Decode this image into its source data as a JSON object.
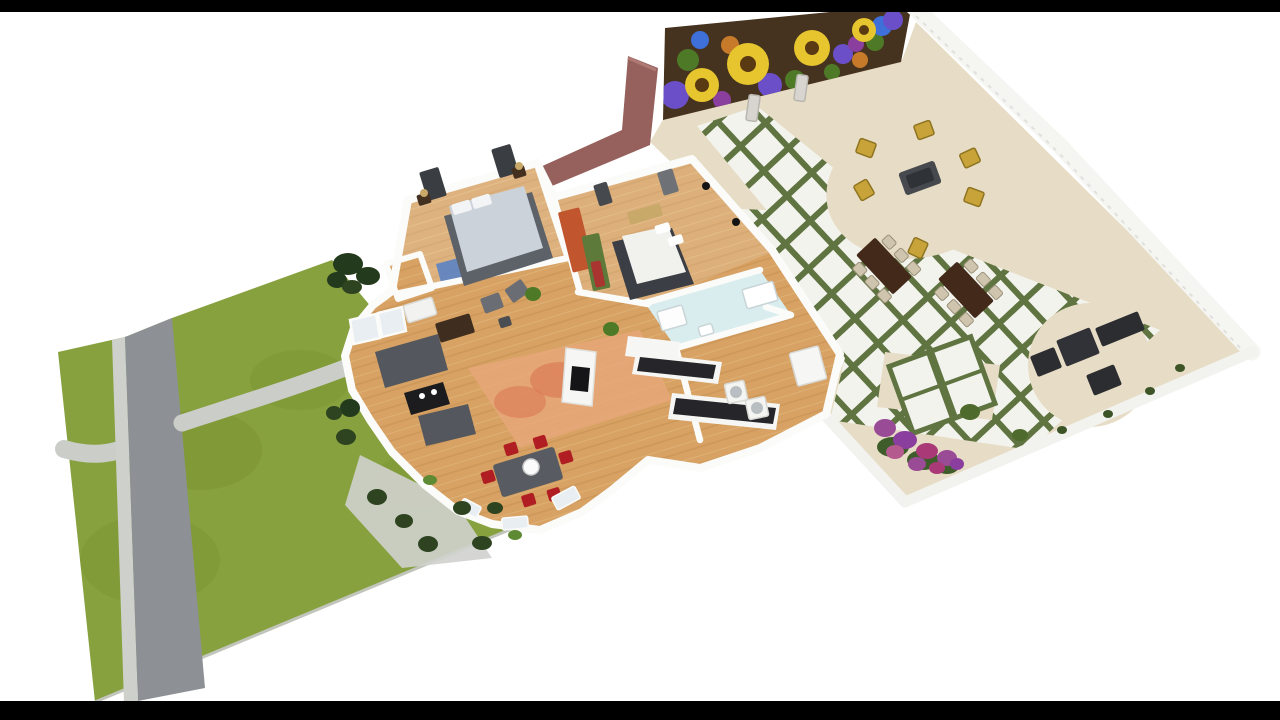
{
  "palette": {
    "background": "#ffffff",
    "letterbox": "#000000",
    "lawn": "#87a13f",
    "lawnPatch": "#79932f",
    "lawnRim": "#c2c5bb",
    "road": "#8d9195",
    "roadEdge": "#cdd0cb",
    "path": "#cbcdc9",
    "apron": "#d0d2ce",
    "patioFloor": "#e7dcc5",
    "tileWhite": "#f3f3ee",
    "tileGrout": "#5f7440",
    "fence": "#f5f5f2",
    "fenceLine": "#e0e0dc",
    "patioWall": "#f2f2ef",
    "muralBase": "#46331f",
    "muralYellow": "#e6c52f",
    "muralCenter": "#5a3a12",
    "muralPurple": "#6a4fc8",
    "muralMagenta": "#8a3f9e",
    "muralLeaf": "#4e7a28",
    "muralBlue": "#3f6fd8",
    "muralOrange": "#c77b2a",
    "maroonWall": "#96605c",
    "wall": "#fbfbf9",
    "wood": "#d7a263",
    "woodLine": "#c08a4c",
    "bathFloor": "#d9edef",
    "rugOrange": "#e8a77b",
    "rugSpot": "#d96f4e",
    "rugBlue": "#5b82c4",
    "bedPlatform": "#5d6168",
    "bedGray": "#ccd2d9",
    "bedWhite": "#f1f1ee",
    "bedDark": "#3b3f45",
    "sofaGray": "#54575d",
    "coffeeTable": "#1c1c1f",
    "diningTable": "#585c62",
    "redChair": "#b01e23",
    "counterBlack": "#26262a",
    "cabinetWhite": "#f6f6f4",
    "patioTableBrown": "#43291a",
    "patioChairPale": "#cfc5ae",
    "loungeDark": "#2c2d31",
    "seatYellow": "#c7a339",
    "seatTableGray": "#46494e",
    "shrubDark": "#2e4420",
    "bushDark": "#243a1c",
    "shrubBright": "#5d8a33",
    "patioShrub": "#4e6b2d",
    "flowerGreen": "#3f5d2a",
    "flowerPurple": "#9a4b96",
    "flowerViolet": "#8a3f9e",
    "flowerMagenta": "#a93a77",
    "flowerPink": "#b55a8f",
    "glass": "#e8eef2",
    "vase": "#d8d5d0"
  },
  "scene": {
    "stamps": [
      {
        "name": "master-window-icon",
        "type": "rect",
        "x": 433,
        "y": 184,
        "w": 20,
        "h": 30,
        "rot": -17,
        "fill": "#3a3d42"
      },
      {
        "name": "master-window-icon",
        "type": "rect",
        "x": 505,
        "y": 161,
        "w": 20,
        "h": 30,
        "rot": -17,
        "fill": "#3a3d42"
      },
      {
        "name": "bedroom2-window-icon",
        "type": "rect",
        "x": 603,
        "y": 194,
        "w": 14,
        "h": 22,
        "rot": -17,
        "fill": "#46494e"
      },
      {
        "name": "bedroom2-window-icon",
        "type": "rect",
        "x": 668,
        "y": 182,
        "w": 16,
        "h": 24,
        "rot": -17,
        "fill": "#6e7276"
      },
      {
        "name": "nightstand",
        "type": "rect",
        "x": 424,
        "y": 199,
        "w": 13,
        "h": 11,
        "rot": -17,
        "fill": "#43301f"
      },
      {
        "name": "nightstand",
        "type": "rect",
        "x": 519,
        "y": 172,
        "w": 13,
        "h": 11,
        "rot": -17,
        "fill": "#43301f"
      },
      {
        "name": "lamp",
        "type": "ellipse",
        "x": 424,
        "y": 193,
        "rx": 4,
        "ry": 4,
        "fill": "#c9a969"
      },
      {
        "name": "lamp",
        "type": "ellipse",
        "x": 519,
        "y": 166,
        "rx": 4,
        "ry": 4,
        "fill": "#c9a969"
      },
      {
        "name": "hall-art-panel",
        "type": "rect",
        "x": 576,
        "y": 240,
        "w": 22,
        "h": 62,
        "rot": -14,
        "fill": "#c0552e"
      },
      {
        "name": "hall-art-panel",
        "type": "rect",
        "x": 596,
        "y": 262,
        "w": 18,
        "h": 56,
        "rot": -12,
        "fill": "#5d7a3b"
      },
      {
        "name": "hall-art-panel",
        "type": "rect",
        "x": 598,
        "y": 274,
        "w": 10,
        "h": 26,
        "rot": -12,
        "fill": "#a8352f"
      },
      {
        "name": "bedroom2-bench",
        "type": "rect",
        "x": 645,
        "y": 214,
        "w": 34,
        "h": 13,
        "rot": -16,
        "fill": "#c9a969"
      },
      {
        "name": "wall-speaker-icon",
        "type": "ellipse",
        "x": 706,
        "y": 186,
        "rx": 4,
        "ry": 4,
        "fill": "#141414"
      },
      {
        "name": "wall-speaker-icon",
        "type": "ellipse",
        "x": 736,
        "y": 222,
        "rx": 4,
        "ry": 4,
        "fill": "#141414"
      },
      {
        "name": "dresser",
        "type": "rect",
        "x": 420,
        "y": 310,
        "w": 30,
        "h": 18,
        "rot": -17,
        "fill": "#f2f2f0",
        "stroke": "#d8d8d4"
      },
      {
        "name": "tv-cabinet",
        "type": "rect",
        "x": 455,
        "y": 328,
        "w": 36,
        "h": 20,
        "rot": -17,
        "fill": "#3f2d1f"
      },
      {
        "name": "armchair",
        "type": "rect",
        "x": 492,
        "y": 303,
        "w": 20,
        "h": 16,
        "rot": -20,
        "fill": "#6a6e74"
      },
      {
        "name": "armchair",
        "type": "rect",
        "x": 517,
        "y": 291,
        "w": 20,
        "h": 16,
        "rot": -35,
        "fill": "#6a6e74"
      },
      {
        "name": "side-table",
        "type": "rect",
        "x": 505,
        "y": 322,
        "w": 12,
        "h": 10,
        "rot": -17,
        "fill": "#4a4d52"
      },
      {
        "name": "plant",
        "type": "ellipse",
        "x": 533,
        "y": 294,
        "rx": 8,
        "ry": 7,
        "fill": "#4e7a28"
      },
      {
        "name": "plant",
        "type": "ellipse",
        "x": 611,
        "y": 329,
        "rx": 8,
        "ry": 7,
        "fill": "#4e7a28"
      },
      {
        "name": "bathtub",
        "type": "rect",
        "x": 760,
        "y": 295,
        "w": 32,
        "h": 20,
        "rot": -16,
        "fill": "#ffffff",
        "stroke": "#c9d4d6"
      },
      {
        "name": "shower",
        "type": "rect",
        "x": 672,
        "y": 318,
        "w": 26,
        "h": 20,
        "rot": -16,
        "fill": "#fdfdfd",
        "stroke": "#c9d4d6"
      },
      {
        "name": "bathroom-sink",
        "type": "rect",
        "x": 706,
        "y": 330,
        "w": 14,
        "h": 10,
        "rot": -16,
        "fill": "#ffffff",
        "stroke": "#c9d4d6"
      },
      {
        "name": "washer",
        "type": "rect",
        "x": 736,
        "y": 392,
        "w": 20,
        "h": 20,
        "rot": -12,
        "fill": "#f4f4f2",
        "stroke": "#d8d8d4"
      },
      {
        "name": "dryer",
        "type": "rect",
        "x": 757,
        "y": 408,
        "w": 20,
        "h": 20,
        "rot": -12,
        "fill": "#f4f4f2",
        "stroke": "#d8d8d4"
      },
      {
        "name": "washer-door-icon",
        "type": "ellipse",
        "x": 736,
        "y": 392,
        "rx": 6,
        "ry": 6,
        "fill": "#b9bec2"
      },
      {
        "name": "dryer-door-icon",
        "type": "ellipse",
        "x": 757,
        "y": 408,
        "rx": 6,
        "ry": 6,
        "fill": "#b9bec2"
      },
      {
        "name": "fridge",
        "type": "rect",
        "x": 808,
        "y": 366,
        "w": 30,
        "h": 34,
        "rot": -15,
        "fill": "#f6f6f4",
        "stroke": "#d8d8d4"
      },
      {
        "name": "bay-window",
        "type": "rect",
        "x": 566,
        "y": 498,
        "w": 26,
        "h": 14,
        "rot": -28,
        "fill": "#e8eef2",
        "stroke": "#fbfbf9"
      },
      {
        "name": "bay-window",
        "type": "rect",
        "x": 515,
        "y": 523,
        "w": 26,
        "h": 12,
        "rot": -5,
        "fill": "#e8eef2",
        "stroke": "#fbfbf9"
      },
      {
        "name": "bay-window",
        "type": "rect",
        "x": 470,
        "y": 508,
        "w": 20,
        "h": 12,
        "rot": 28,
        "fill": "#e8eef2",
        "stroke": "#fbfbf9"
      },
      {
        "name": "pendant-light",
        "type": "ellipse",
        "x": 531,
        "y": 467,
        "rx": 8,
        "ry": 8,
        "fill": "#fbfbfb",
        "stroke": "#cccccc"
      },
      {
        "name": "garden-bush",
        "type": "ellipse",
        "x": 348,
        "y": 264,
        "rx": 15,
        "ry": 11,
        "fill": "#243a1c"
      },
      {
        "name": "garden-bush",
        "type": "ellipse",
        "x": 368,
        "y": 276,
        "rx": 12,
        "ry": 9,
        "fill": "#243a1c"
      },
      {
        "name": "garden-bush",
        "type": "ellipse",
        "x": 337,
        "y": 280,
        "rx": 10,
        "ry": 8,
        "fill": "#243a1c"
      },
      {
        "name": "garden-bush",
        "type": "ellipse",
        "x": 352,
        "y": 287,
        "rx": 10,
        "ry": 7,
        "fill": "#2e4420"
      },
      {
        "name": "garden-bush",
        "type": "ellipse",
        "x": 350,
        "y": 408,
        "rx": 10,
        "ry": 9,
        "fill": "#243a1c"
      },
      {
        "name": "garden-bush",
        "type": "ellipse",
        "x": 334,
        "y": 413,
        "rx": 8,
        "ry": 7,
        "fill": "#2e4420"
      },
      {
        "name": "garden-shrub",
        "type": "ellipse",
        "x": 346,
        "y": 437,
        "rx": 10,
        "ry": 8,
        "fill": "#2e4420"
      },
      {
        "name": "garden-shrub",
        "type": "ellipse",
        "x": 377,
        "y": 497,
        "rx": 10,
        "ry": 8,
        "fill": "#2e4420"
      },
      {
        "name": "garden-shrub",
        "type": "ellipse",
        "x": 404,
        "y": 521,
        "rx": 9,
        "ry": 7,
        "fill": "#2e4420"
      },
      {
        "name": "garden-shrub",
        "type": "ellipse",
        "x": 428,
        "y": 544,
        "rx": 10,
        "ry": 8,
        "fill": "#2e4420"
      },
      {
        "name": "garden-shrub",
        "type": "ellipse",
        "x": 462,
        "y": 508,
        "rx": 9,
        "ry": 7,
        "fill": "#2e4420"
      },
      {
        "name": "garden-shrub",
        "type": "ellipse",
        "x": 482,
        "y": 543,
        "rx": 10,
        "ry": 7,
        "fill": "#2e4420"
      },
      {
        "name": "garden-shrub",
        "type": "ellipse",
        "x": 495,
        "y": 508,
        "rx": 8,
        "ry": 6,
        "fill": "#2e4420"
      },
      {
        "name": "garden-shrub-bright",
        "type": "ellipse",
        "x": 430,
        "y": 480,
        "rx": 7,
        "ry": 5,
        "fill": "#5d8a33"
      },
      {
        "name": "garden-shrub-bright",
        "type": "ellipse",
        "x": 515,
        "y": 535,
        "rx": 7,
        "ry": 5,
        "fill": "#5d8a33"
      },
      {
        "name": "patio-vase",
        "type": "rect",
        "x": 753,
        "y": 108,
        "w": 11,
        "h": 26,
        "rot": 8,
        "fill": "#d8d5d0",
        "stroke": "#b9b6b0"
      },
      {
        "name": "patio-vase",
        "type": "rect",
        "x": 801,
        "y": 88,
        "w": 11,
        "h": 26,
        "rot": 8,
        "fill": "#d8d5d0",
        "stroke": "#b9b6b0"
      },
      {
        "name": "patio-armchair",
        "type": "rect",
        "x": 924,
        "y": 130,
        "w": 17,
        "h": 15,
        "rot": -20,
        "fill": "#c7a339",
        "stroke": "#8f7420"
      },
      {
        "name": "patio-armchair",
        "type": "rect",
        "x": 866,
        "y": 148,
        "w": 17,
        "h": 15,
        "rot": 20,
        "fill": "#c7a339",
        "stroke": "#8f7420"
      },
      {
        "name": "patio-armchair",
        "type": "rect",
        "x": 864,
        "y": 190,
        "w": 17,
        "h": 15,
        "rot": 60,
        "fill": "#c7a339",
        "stroke": "#8f7420"
      },
      {
        "name": "patio-armchair",
        "type": "rect",
        "x": 918,
        "y": 248,
        "w": 17,
        "h": 15,
        "rot": 115,
        "fill": "#c7a339",
        "stroke": "#8f7420"
      },
      {
        "name": "patio-armchair",
        "type": "rect",
        "x": 974,
        "y": 197,
        "w": 17,
        "h": 15,
        "rot": 200,
        "fill": "#c7a339",
        "stroke": "#8f7420"
      },
      {
        "name": "patio-armchair",
        "type": "rect",
        "x": 970,
        "y": 158,
        "w": 17,
        "h": 15,
        "rot": 155,
        "fill": "#c7a339",
        "stroke": "#8f7420"
      },
      {
        "name": "lounge-table",
        "type": "rect",
        "x": 1078,
        "y": 347,
        "w": 36,
        "h": 28,
        "rot": -22,
        "fill": "#313237"
      },
      {
        "name": "lounge-sofa",
        "type": "rect",
        "x": 1120,
        "y": 329,
        "w": 46,
        "h": 20,
        "rot": -22,
        "fill": "#2c2d31"
      },
      {
        "name": "lounge-chair",
        "type": "rect",
        "x": 1046,
        "y": 362,
        "w": 26,
        "h": 22,
        "rot": -22,
        "fill": "#2c2d31"
      },
      {
        "name": "lounge-chair",
        "type": "rect",
        "x": 1104,
        "y": 380,
        "w": 30,
        "h": 22,
        "rot": -22,
        "fill": "#2c2d31"
      },
      {
        "name": "patio-shrub",
        "type": "ellipse",
        "x": 970,
        "y": 412,
        "rx": 10,
        "ry": 8,
        "fill": "#4e6b2d"
      },
      {
        "name": "patio-shrub",
        "type": "ellipse",
        "x": 1020,
        "y": 435,
        "rx": 8,
        "ry": 6,
        "fill": "#4e6b2d"
      },
      {
        "name": "patio-shrub",
        "type": "ellipse",
        "x": 1180,
        "y": 368,
        "rx": 5,
        "ry": 4,
        "fill": "#3d5526"
      },
      {
        "name": "patio-shrub",
        "type": "ellipse",
        "x": 1150,
        "y": 391,
        "rx": 5,
        "ry": 4,
        "fill": "#3d5526"
      },
      {
        "name": "patio-shrub",
        "type": "ellipse",
        "x": 1108,
        "y": 414,
        "rx": 5,
        "ry": 4,
        "fill": "#3d5526"
      },
      {
        "name": "patio-shrub",
        "type": "ellipse",
        "x": 1062,
        "y": 430,
        "rx": 5,
        "ry": 4,
        "fill": "#3d5526"
      },
      {
        "name": "flower-foliage",
        "type": "ellipse",
        "x": 893,
        "y": 447,
        "rx": 16,
        "ry": 10,
        "fill": "#3f5d2a"
      },
      {
        "name": "flower-foliage",
        "type": "ellipse",
        "x": 923,
        "y": 460,
        "rx": 16,
        "ry": 10,
        "fill": "#3f5d2a"
      },
      {
        "name": "flower-foliage",
        "type": "ellipse",
        "x": 947,
        "y": 466,
        "rx": 12,
        "ry": 8,
        "fill": "#3f5d2a"
      },
      {
        "name": "flower-cluster",
        "type": "ellipse",
        "x": 885,
        "y": 428,
        "rx": 11,
        "ry": 9,
        "fill": "#9a4b96"
      },
      {
        "name": "flower-cluster",
        "type": "ellipse",
        "x": 905,
        "y": 440,
        "rx": 12,
        "ry": 9,
        "fill": "#8a3f9e"
      },
      {
        "name": "flower-cluster",
        "type": "ellipse",
        "x": 927,
        "y": 451,
        "rx": 11,
        "ry": 8,
        "fill": "#a93a77"
      },
      {
        "name": "flower-cluster",
        "type": "ellipse",
        "x": 947,
        "y": 458,
        "rx": 10,
        "ry": 8,
        "fill": "#9a4b96"
      },
      {
        "name": "flower-cluster",
        "type": "ellipse",
        "x": 895,
        "y": 452,
        "rx": 9,
        "ry": 7,
        "fill": "#b55a8f"
      },
      {
        "name": "flower-cluster",
        "type": "ellipse",
        "x": 917,
        "y": 464,
        "rx": 9,
        "ry": 7,
        "fill": "#9a4b96"
      },
      {
        "name": "flower-cluster",
        "type": "ellipse",
        "x": 937,
        "y": 468,
        "rx": 8,
        "ry": 6,
        "fill": "#a93a77"
      },
      {
        "name": "flower-cluster",
        "type": "ellipse",
        "x": 957,
        "y": 464,
        "rx": 7,
        "ry": 6,
        "fill": "#8a3f9e"
      }
    ]
  }
}
